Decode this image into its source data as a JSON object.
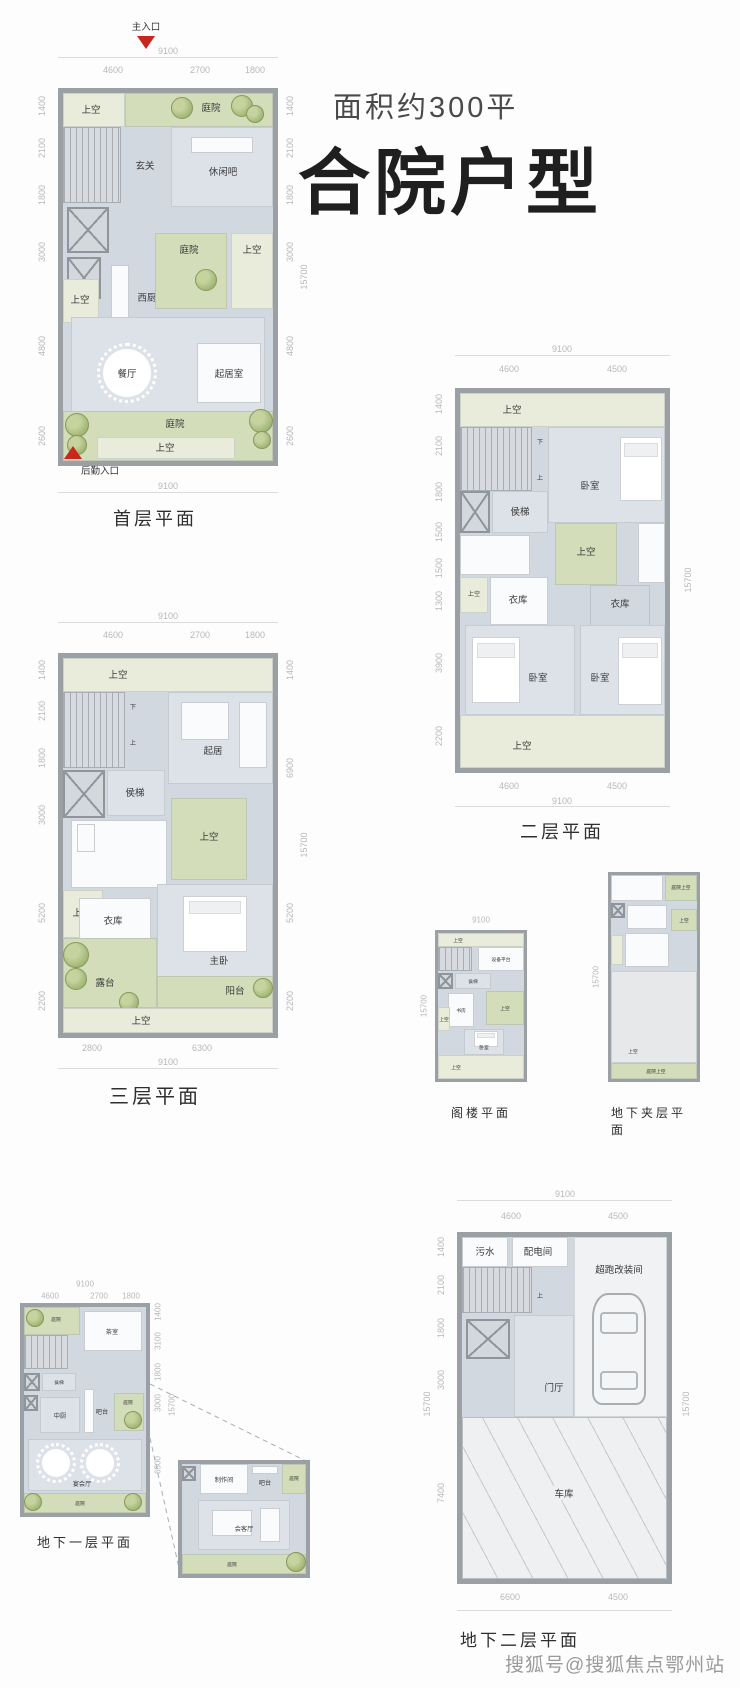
{
  "header": {
    "area_label": "面积约300平",
    "type_label": "合院户型"
  },
  "watermark": "搜狐号@搜狐焦点鄂州站",
  "plans": {
    "f1": {
      "title": "首层平面",
      "entrance_main": "主入口",
      "entrance_service": "后勤入口",
      "rooms": {
        "void_tl": "上空",
        "court_top": "庭院",
        "foyer": "玄关",
        "lounge": "休闲吧",
        "west_kitchen": "西厨",
        "void_left": "上空",
        "court_mid": "庭院",
        "void_mid_right": "上空",
        "dining": "餐厅",
        "living": "起居室",
        "court_bottom": "庭院",
        "void_bottom": "上空"
      },
      "dims": {
        "top_total": "9100",
        "top": [
          "4600",
          "2700",
          "1800"
        ],
        "left": [
          "1400",
          "2100",
          "1800",
          "3000",
          "4800",
          "2600"
        ],
        "right": [
          "1400",
          "2100",
          "1800",
          "3000",
          "4800",
          "2600"
        ],
        "side_total": "15700",
        "bottom_total": "9100"
      }
    },
    "f2": {
      "title": "二层平面",
      "stair_down": "下",
      "stair_up": "上",
      "rooms": {
        "void_top": "上空",
        "bedroom_tr": "卧室",
        "lift": "侯梯",
        "void_left": "上空",
        "closet_left": "衣库",
        "void_center": "上空",
        "closet_right": "衣库",
        "bedroom_bl": "卧室",
        "bedroom_br": "卧室",
        "void_bottom": "上空"
      },
      "dims": {
        "top_total": "9100",
        "top": [
          "4600",
          "4500"
        ],
        "left": [
          "1400",
          "2100",
          "1800",
          "1500",
          "1500",
          "1300",
          "3900",
          "2200"
        ],
        "side_total": "15700",
        "bottom": [
          "4600",
          "4500"
        ],
        "bottom_total": "9100"
      }
    },
    "f3": {
      "title": "三层平面",
      "stair_down": "下",
      "stair_up": "上",
      "rooms": {
        "void_top": "上空",
        "living": "起居",
        "lift": "侯梯",
        "void_left": "上空",
        "void_center": "上空",
        "closet": "衣库",
        "master_bedroom": "主卧",
        "terrace": "露台",
        "balcony": "阳台",
        "void_bottom": "上空"
      },
      "dims": {
        "top_total": "9100",
        "top": [
          "4600",
          "2700",
          "1800"
        ],
        "left": [
          "1400",
          "2100",
          "1800",
          "3000",
          "5200",
          "2200"
        ],
        "right": [
          "1400",
          "6900",
          "5200",
          "2200"
        ],
        "side_total": "15700",
        "bottom": [
          "2800",
          "6300"
        ],
        "bottom_total": "9100"
      }
    },
    "attic": {
      "title": "阁楼平面",
      "rooms": {
        "void_top": "上空",
        "equipment": "设备平台",
        "lift": "侯梯",
        "study": "书房",
        "void_left": "上空",
        "void_right": "上空",
        "bedroom": "卧室",
        "void_bottom": "上空"
      },
      "dims": {
        "top_total": "9100",
        "side_total": "15700"
      }
    },
    "mezz": {
      "title": "地下夹层平面",
      "rooms": {
        "court_void_top": "庭院上空",
        "void_mid": "上空",
        "void_main": "上空",
        "court_void_bottom": "庭院上空"
      },
      "dims": {
        "side_total": "15700"
      }
    },
    "b1": {
      "title": "地下一层平面",
      "rooms": {
        "court_tl": "庭院",
        "tea_room": "茶室",
        "lift": "侯梯",
        "kitchen": "中厨",
        "bar": "吧台",
        "court_right": "庭院",
        "banquet": "宴会厅",
        "court_bottom": "庭院"
      },
      "dims": {
        "top_total": "9100",
        "top": [
          "4600",
          "2700",
          "1800"
        ],
        "right": [
          "1400",
          "3100",
          "1800",
          "3000",
          "6500"
        ],
        "side_total": "15700"
      }
    },
    "callout": {
      "rooms": {
        "prep_room": "制作间",
        "bar": "吧台",
        "court_right": "庭院",
        "reception": "会客厅",
        "court_bottom": "庭院"
      }
    },
    "b2": {
      "title": "地下二层平面",
      "stair_up": "上",
      "rooms": {
        "sewage": "污水",
        "power_room": "配电间",
        "supercar_room": "超跑改装间",
        "entry_hall": "门厅",
        "garage": "车库"
      },
      "dims": {
        "top_total": "9100",
        "top": [
          "4600",
          "4500"
        ],
        "left": [
          "1400",
          "2100",
          "1800",
          "3000",
          "7400"
        ],
        "left_total": "15700",
        "right_total": "15700",
        "bottom": [
          "6600",
          "4500"
        ]
      }
    }
  }
}
